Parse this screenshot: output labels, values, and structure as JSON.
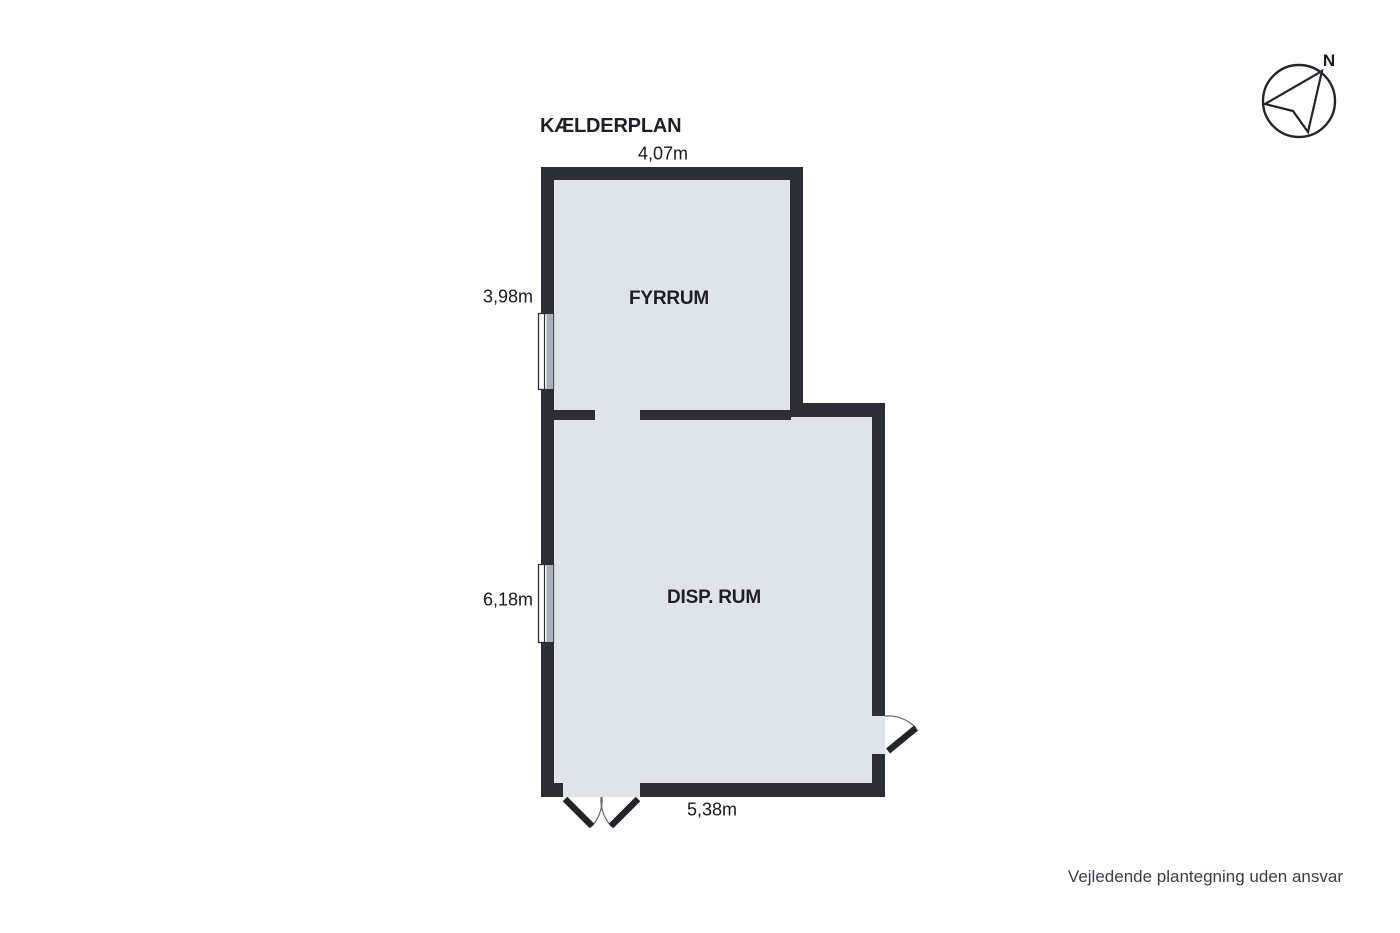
{
  "title": "KÆLDERPLAN",
  "disclaimer": "Vejledende plantegning uden ansvar",
  "compass": {
    "north_label": "N"
  },
  "rooms": [
    {
      "label": "FYRRUM",
      "width": "4,07m",
      "height": "3,98m"
    },
    {
      "label": "DISP. RUM",
      "width": "5,38m",
      "height": "6,18m"
    }
  ],
  "dimensions": {
    "top": "4,07m",
    "upper_left": "3,98m",
    "lower_left": "6,18m",
    "bottom": "5,38m"
  },
  "colors": {
    "wall": "#2b2f35",
    "room_fill": "#dfe4ea",
    "window_pane": "#a9afb6",
    "door_leaf": "#22262b",
    "swing_arc": "#6b6e72",
    "text": "#1d2126"
  }
}
